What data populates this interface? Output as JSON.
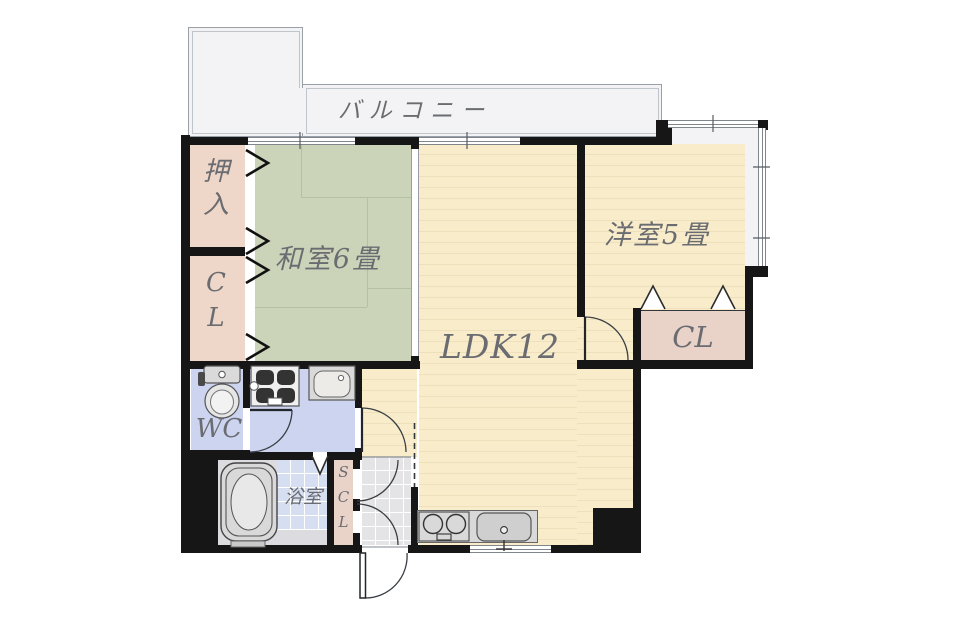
{
  "title": "apartment-floor-plan",
  "rooms": {
    "balcony": {
      "label": "バルコニー"
    },
    "japanese_room": {
      "label": "和室6畳"
    },
    "western_room": {
      "label": "洋室5畳"
    },
    "ldk": {
      "label": "LDK12"
    },
    "oshiire_closet": {
      "label": "押\n入"
    },
    "closet_left": {
      "label": "C\nL"
    },
    "closet_right": {
      "label": "CL"
    },
    "toilet_room": {
      "label": "WC"
    },
    "bathroom": {
      "label": "浴室"
    },
    "shoe_closet": {
      "label": "S\nC\nL"
    }
  },
  "colors": {
    "wall": "#161616",
    "tatami": "#cbd4b9",
    "tatami-line": "#b5c0a2",
    "wood": "#f8ecca",
    "wood-stripe": "#eee0ba",
    "closet": "#eed7c8",
    "closet-right": "#e9d3c9",
    "water": "#ccd4ef",
    "bath-tile": "#d6def2",
    "balcony": "#f3f3f5",
    "window-area": "#f3f3f5",
    "fixture": "#d9d9d9",
    "entry-tile": "#e4e4e6",
    "label": "#6b6c71"
  }
}
